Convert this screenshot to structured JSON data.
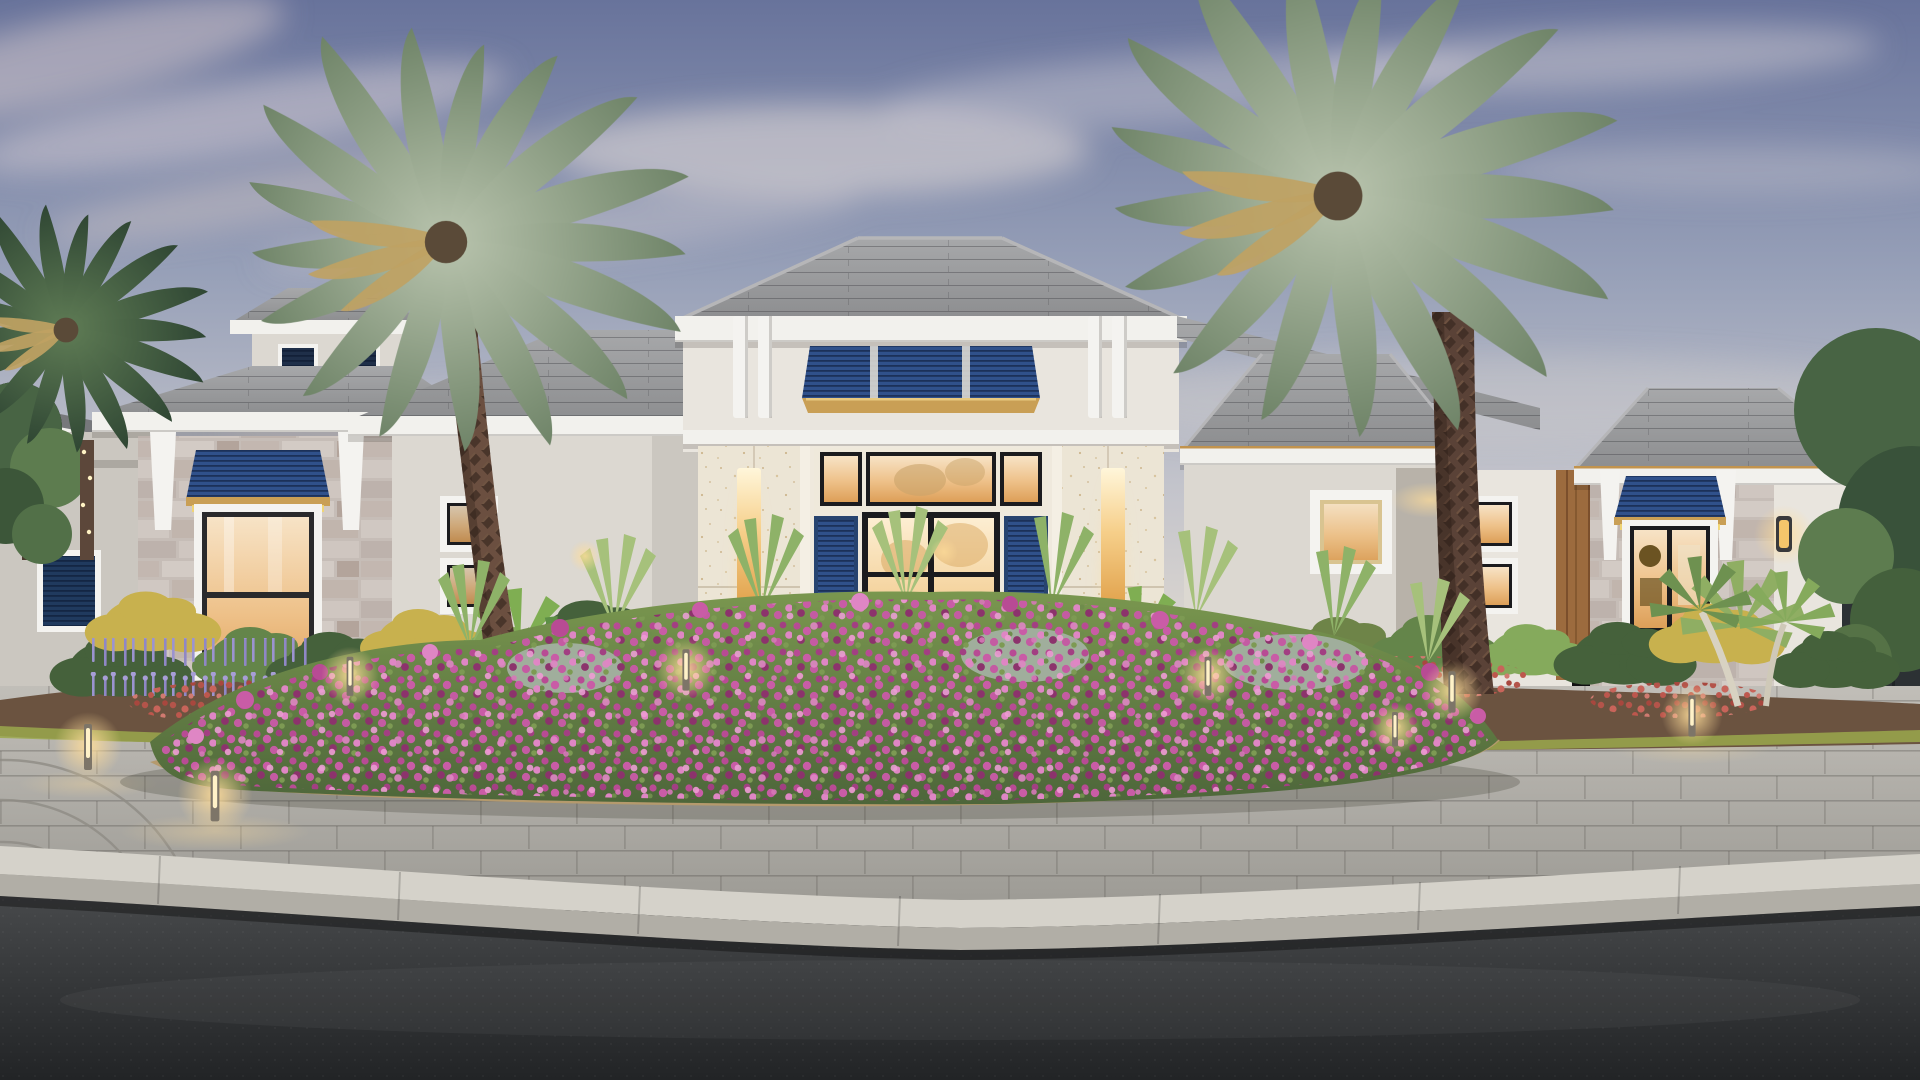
{
  "scene": {
    "description": "Photorealistic dusk rendering of a coastal contemporary single-story luxury home: grey flat-tile hip roofs with a tall central entry tower, navy Bahama louvered awnings and shutters, cream stucco and grey stone-veneer walls, warm-lit glass double entry doors and windows, two mature canary palms flanking the entry, a flowering landscape island of magenta groundcover in a grey paver circular driveway, lavender and red flower beds, bollard path lights, concrete curb and dark asphalt street in the foreground under a blue-grey evening sky with soft clouds.",
    "time_of_day": "dusk",
    "style": "coastal contemporary",
    "house": {
      "roof": "grey flat concrete tile hip roofs with white fascia",
      "entry_tower": "raised tower with navy louvered clerestory band, gold trim lip, white vertical fins, cream travertine pilasters with lit niches",
      "entry_door": "black-framed glass double doors with transom windows, warm interior glow, navy louvered shutters",
      "accents": "grey ledgestone veneer, white corbels, navy Bahama awnings with gold edge, cupola with louver vents, wood-look panel, wall sconce"
    },
    "landscape": {
      "island_bed": "magenta flowering groundcover with light green strap-leaf plants and silver foliage over straw mulch",
      "foundation_beds": "green/gold shrubs, lavender spikes, red flower drifts, fan palmettos, dark mulch",
      "hardscape": "large-format grey paver driveway with fan-arc detail, concrete curb, asphalt road"
    },
    "counts": {
      "palm_trees": 3,
      "bahama_awnings": 3,
      "bollard_lights": 8,
      "lit_openings": 12
    }
  },
  "palette": {
    "sky_top": "#68739b",
    "sky_mid": "#97a0b8",
    "sky_low": "#c2c3cb",
    "horizon": "#ded8d0",
    "roof_main": "#8d8e90",
    "roof_light": "#a7a8aa",
    "roof_dark": "#77787b",
    "fascia": "#f2f1ed",
    "wall_light": "#e9e5de",
    "wall_mid": "#dcd8d1",
    "wall_shade": "#cbc7c0",
    "stone_base": "#c6bdb7",
    "travertine": "#ece5d5",
    "blue": "#30518b",
    "blue_dark": "#27436f",
    "gold_trim": "#c99f55",
    "awning_glow": "#f3d66d",
    "frame_dark": "#1b1b1e",
    "glass_top": "#f7e3c6",
    "glass_mid": "#eec189",
    "glass_deep": "#dd9f58",
    "paver": "#b7b4ae",
    "paver_dark": "#9c9a94",
    "curb_top": "#d5d2ca",
    "curb_face": "#b1aea6",
    "asphalt_top": "#47494b",
    "asphalt_bottom": "#222426",
    "foliage_dark": "#45613b",
    "foliage_mid": "#64854a",
    "foliage_light": "#85aa5c",
    "bush_gold": "#c8b14e",
    "olive": "#6e8448",
    "red_flower": "#b4544a",
    "magenta": "#b84b94",
    "magenta_light": "#df86c4",
    "magenta_deep": "#8c336c",
    "lavender": "#8f87c6",
    "silver": "#a0ae9c",
    "mulch": "#6b5340",
    "straw": "#b59a6d",
    "trunk": "#6b4f40",
    "trunk_dark": "#46332b",
    "trunk_right": "#5a4237",
    "glow": "#ffdd9a"
  }
}
